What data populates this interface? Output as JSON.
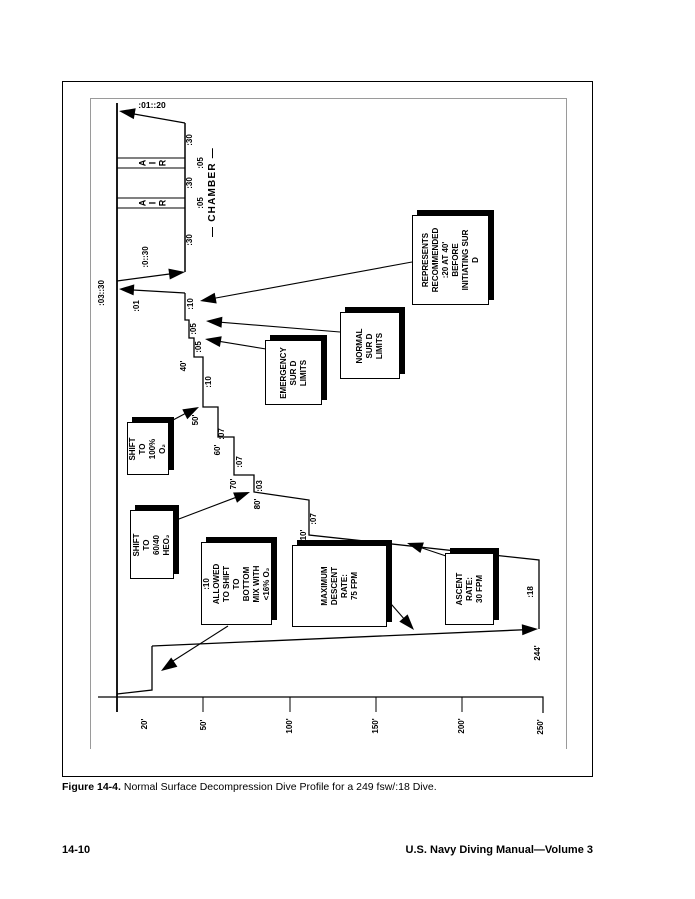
{
  "page": {
    "caption_label": "Figure 14-4.",
    "caption_text": "Normal Surface Decompression Dive Profile for a 249 fsw/:18 Dive.",
    "footer_left": "14-10",
    "footer_right": "U.S. Navy Diving Manual—Volume 3"
  },
  "diagram": {
    "chamber": {
      "title": "— CHAMBER —",
      "final_ascent_time": ":01::20",
      "o2_period_1": ":30",
      "air_break_1": ":05",
      "o2_period_2": ":30",
      "air_break_2": ":05",
      "o2_period_3": ":30",
      "air_letters": [
        "A",
        "I",
        "R"
      ],
      "descent_time": ":0::30"
    },
    "surface_interval": ":03::30",
    "ascent_to_surface_time": ":01",
    "water_stops": {
      "s40_depth": "40'",
      "s40_time": ":10",
      "s40_ext1": ":05",
      "s40_ext2": ":05",
      "s50_depth": "50'",
      "s50_time": ":10",
      "s60_depth": "60'",
      "s60_time": ":07",
      "s70_depth": "70'",
      "s70_time": ":07",
      "s80_depth": "80'",
      "s80_time": ":03",
      "s110_depth": "110'",
      "s110_time": ":07"
    },
    "bottom": {
      "time": ":18",
      "depth": "244'"
    },
    "axis_labels": [
      "20'",
      "50'",
      "100'",
      "150'",
      "200'",
      "250'"
    ],
    "notes": {
      "shift_o2": "SHIFT TO\n100% O₂",
      "shift_heo2": "SHIFT TO\n60/40 HEO₂",
      "shift_bottom_mix": ":10 ALLOWED\nTO SHIFT TO\nBOTTOM MIX WITH\n<16% O₂",
      "max_descent": "MAXIMUM\nDESCENT RATE:\n75 FPM",
      "ascent_rate": "ASCENT RATE:\n30 FPM",
      "emergency_limits": "EMERGENCY\nSUR D\nLIMITS",
      "normal_limits": "NORMAL\nSUR D\nLIMITS",
      "represents": "REPRESENTS\nRECOMMENDED\n:20 AT 40' BEFORE\nINITIATING SUR D"
    }
  }
}
